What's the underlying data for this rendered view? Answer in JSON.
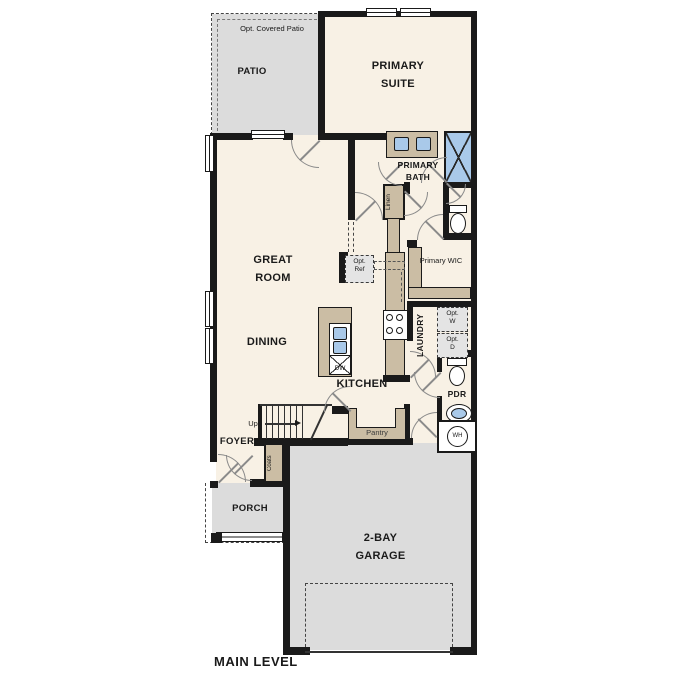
{
  "title": "MAIN LEVEL",
  "colors": {
    "floor": "#f8f1e5",
    "outdoor": "#dcdcdc",
    "casework": "#cbbda4",
    "fixture_blue": "#a9c9e9",
    "wall": "#1a1a1a"
  },
  "rooms": {
    "patio": {
      "label": "PATIO",
      "note": "Opt. Covered Patio"
    },
    "primary_suite": {
      "label": "PRIMARY SUITE"
    },
    "primary_bath": {
      "label": "PRIMARY BATH"
    },
    "linen": {
      "label": "Linen"
    },
    "primary_wic": {
      "label": "Primary WIC"
    },
    "great_room": {
      "label": "GREAT ROOM"
    },
    "dining": {
      "label": "DINING"
    },
    "kitchen": {
      "label": "KITCHEN"
    },
    "laundry": {
      "label": "LAUNDRY"
    },
    "pdr": {
      "label": "PDR"
    },
    "pantry": {
      "label": "Pantry"
    },
    "foyer": {
      "label": "FOYER"
    },
    "coats": {
      "label": "Coats"
    },
    "porch": {
      "label": "PORCH"
    },
    "garage": {
      "label": "2-BAY GARAGE"
    }
  },
  "fixtures": {
    "opt_ref": {
      "line1": "Opt.",
      "line2": "Ref"
    },
    "opt_washer": {
      "line1": "Opt.",
      "line2": "W"
    },
    "opt_dryer": {
      "line1": "Opt.",
      "line2": "D"
    },
    "dishwasher": "DW",
    "water_heater": "WH",
    "stairs_up": "Up"
  }
}
